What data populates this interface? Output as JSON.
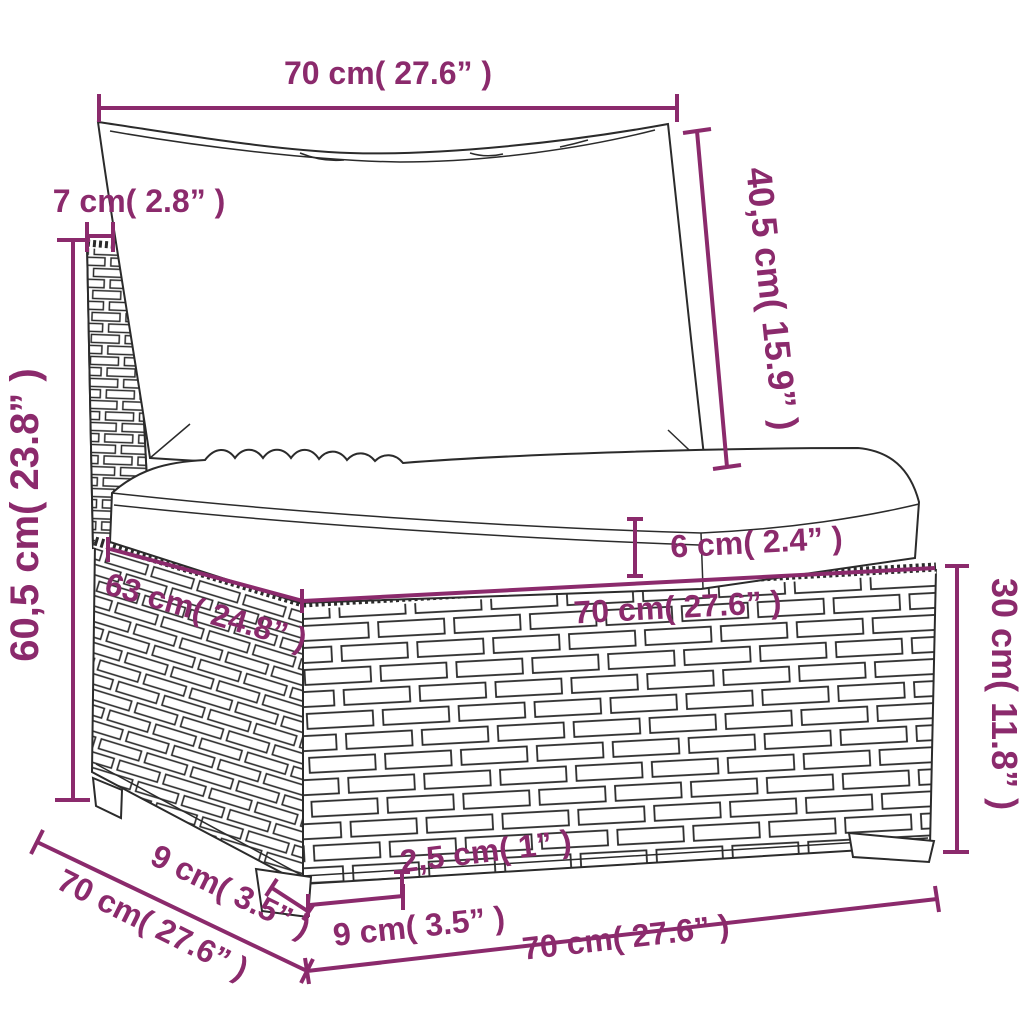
{
  "figure": {
    "kind": "furniture-dimension-diagram",
    "subject": "poly-rattan garden sofa middle section with back and seat cushions",
    "accent_color": "#8B2A6C",
    "outline_color": "#2b2b2b",
    "background_color": "#ffffff"
  },
  "dimensions": {
    "back_cushion_width": "70 cm( 27.6” )",
    "back_cushion_height": "40,5 cm( 15.9” )",
    "back_panel_thickness": "7 cm( 2.8” )",
    "total_height": "60,5 cm( 23.8” )",
    "seat_cushion_thickness": "6 cm( 2.4” )",
    "seat_depth": "63 cm( 24.8” )",
    "seat_width": "70 cm( 27.6” )",
    "base_height": "30 cm( 11.8” )",
    "leg_height": "2,5 cm( 1” )",
    "leg_width": "9 cm( 3.5” )",
    "leg_depth": "9 cm( 3.5” )",
    "overall_depth": "70 cm( 27.6” )",
    "overall_width": "70 cm( 27.6” )"
  }
}
